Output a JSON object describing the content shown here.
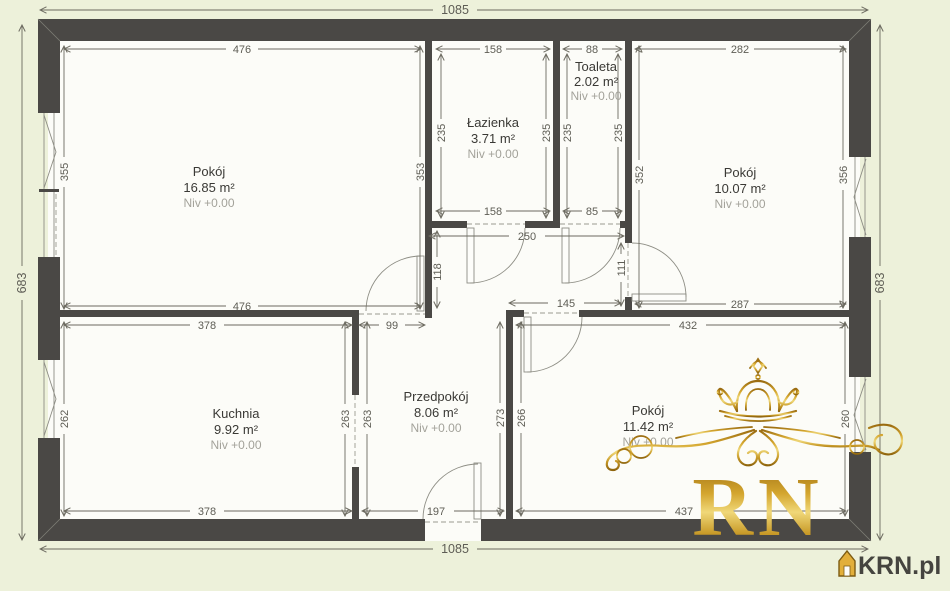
{
  "plan": {
    "rooms": [
      {
        "name": "Pokój",
        "area": "16.85 m²",
        "level": "Niv +0.00"
      },
      {
        "name": "Łazienka",
        "area": "3.71 m²",
        "level": "Niv +0.00"
      },
      {
        "name": "Toaleta",
        "area": "2.02 m²",
        "level": "Niv +0.00"
      },
      {
        "name": "Pokój",
        "area": "10.07 m²",
        "level": "Niv +0.00"
      },
      {
        "name": "Kuchnia",
        "area": "9.92 m²",
        "level": "Niv +0.00"
      },
      {
        "name": "Przedpokój",
        "area": "8.06 m²",
        "level": "Niv +0.00"
      },
      {
        "name": "Pokój",
        "area": "11.42 m²",
        "level": "Niv +0.00"
      }
    ],
    "dims": {
      "top_total": "1085",
      "bottom_total": "1085",
      "left_total": "683",
      "right_total": "683",
      "p1_top": "476",
      "p1_bottom": "476",
      "p1_left": "355",
      "p1_right": "353",
      "laz_top": "158",
      "laz_bottom": "158",
      "laz_left": "235",
      "laz_right": "235",
      "toa_top": "88",
      "toa_bottom": "85",
      "toa_left": "235",
      "toa_right": "235",
      "p2_top": "282",
      "p2_left": "352",
      "p2_right": "356",
      "p2_bottom": "287",
      "p3_top": "432",
      "p3_bottom": "437",
      "p3_right": "260",
      "corridor": "250",
      "corr_left": "118",
      "p2_door": "111",
      "passage": "145",
      "p1_door": "99",
      "kuch_top": "378",
      "kuch_bottom": "378",
      "kuch_left": "262",
      "kuch_wall_l": "263",
      "kuch_wall_r": "263",
      "prz_bottom": "197",
      "prz_left": "273",
      "prz_right": "266"
    },
    "colors": {
      "background": "#edf1da",
      "wall": "#4a4845",
      "dim_text": "#5e5d55",
      "gold": "#c9952c"
    },
    "watermark": {
      "logo_text": "RN",
      "site_label": "KRN.pl"
    }
  }
}
